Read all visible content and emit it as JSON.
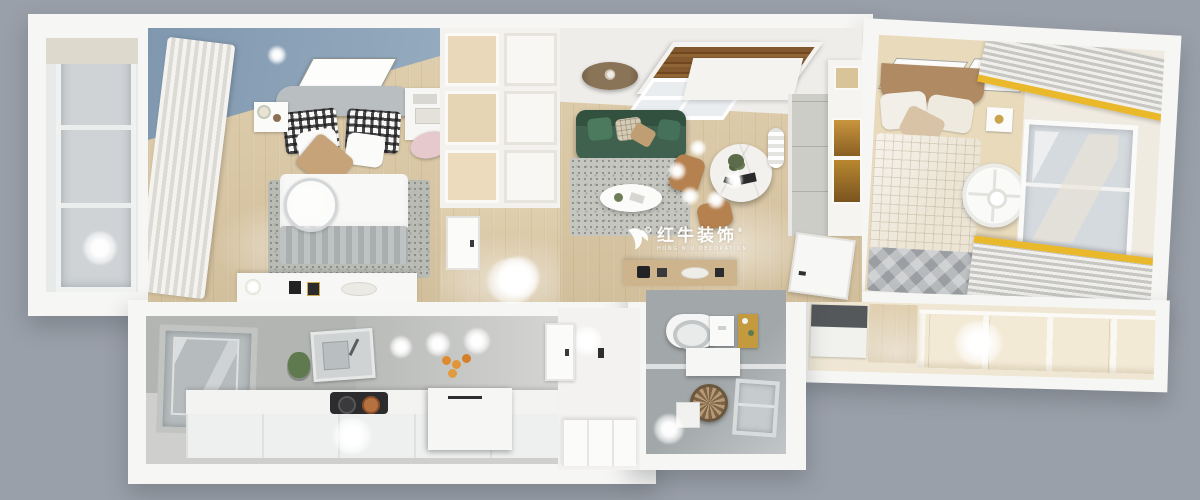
{
  "image": {
    "description": "Photorealistic top-down 3D render of an apartment floor plan",
    "background_color": "#9aa0a9"
  },
  "watermark": {
    "logo_icon": "bull-icon",
    "brand": "红牛装饰",
    "registered": "®",
    "tagline": "HONG NIU DECORATION",
    "color": "#ffffff"
  },
  "palette": {
    "background_gray": "#9aa0a9",
    "wall_white": "#f6f6f4",
    "wood_floor": "#d9c7a6",
    "bedroom_ceiling_blue": "#8098af",
    "sofa_green": "#3f614e",
    "curtain_accent_yellow": "#e9b82b",
    "kitchen_concrete_gray": "#b3b5b3",
    "bathroom_tile_gray": "#a2a8aa",
    "rug_gray": "#c6c6c0",
    "headboard_tan": "#b08a63",
    "chair_pink": "#e6c9cd",
    "wood_blind_brown": "#82592f",
    "dining_chair_tan": "#b5814f"
  }
}
